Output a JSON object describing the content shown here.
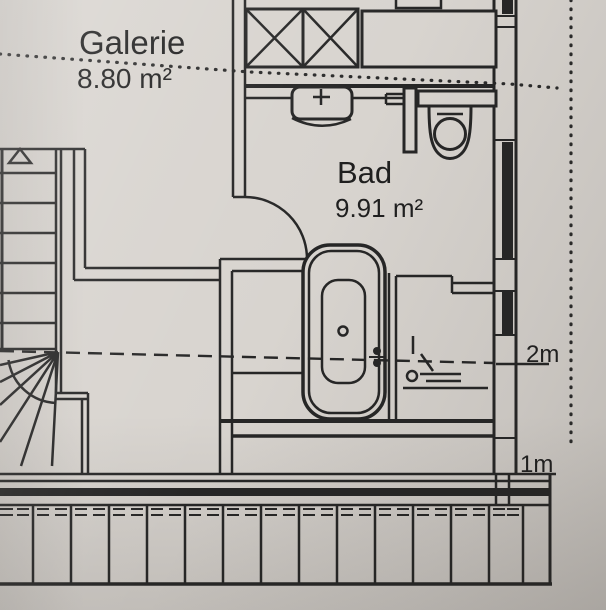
{
  "page": {
    "kind_label": "floor-plan-photo",
    "paper_color": "#d8d4cf",
    "ink_color": "#262626"
  },
  "rooms": [
    {
      "id": "galerie",
      "name": "Galerie",
      "area": "8.80 m²"
    },
    {
      "id": "bad",
      "name": "Bad",
      "area": "9.91 m²"
    }
  ],
  "height_lines": [
    {
      "id": "2m",
      "label": "2m"
    },
    {
      "id": "1m",
      "label": "1m"
    }
  ],
  "fixtures": {
    "staircase": "winder-staircase-with-up-arrow",
    "bathtub": "bathtub-with-drain-and-tap",
    "toilet": "wc-with-cistern",
    "washbasin": "washbasin-with-tap-cross",
    "shower": "shower-corner",
    "shaft": "crossed-duct-shaft",
    "cabinet": "built-in-cabinet",
    "balcony": "balcony-railing-strip",
    "door": "quarter-circle-door-swing",
    "roof_edge": "dotted-roof-outline"
  }
}
